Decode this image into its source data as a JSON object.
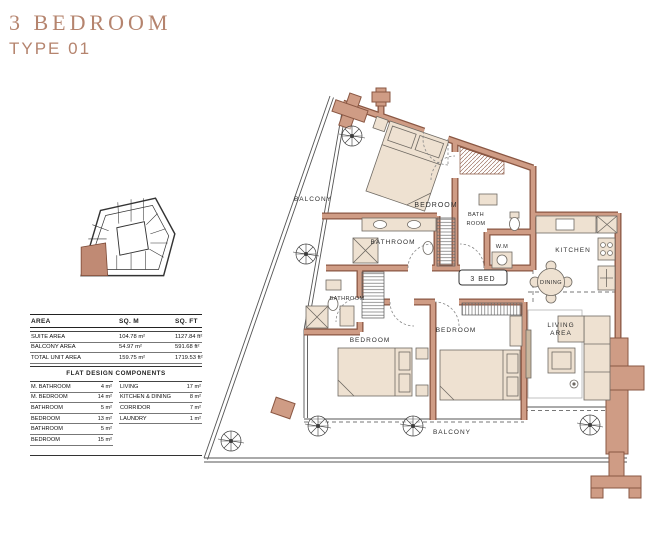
{
  "title": {
    "line1": "3 BEDROOM",
    "line2": "TYPE 01"
  },
  "colors": {
    "accent": "#b5846e",
    "wall_fill": "#cf9c85",
    "wall_edge": "#8a5743",
    "furniture": "#eee1d1",
    "line": "#3c3c3c"
  },
  "area_table": {
    "headers": [
      "AREA",
      "SQ. M",
      "SQ. FT"
    ],
    "rows": [
      {
        "label": "SUITE AREA",
        "sqm": "104.78 m²",
        "sqft": "1127.84 ft²"
      },
      {
        "label": "BALCONY AREA",
        "sqm": "54.97 m²",
        "sqft": "591.68 ft²"
      },
      {
        "label": "TOTAL UNIT AREA",
        "sqm": "159.75 m²",
        "sqft": "1719.53 ft²"
      }
    ]
  },
  "components": {
    "title": "FLAT DESIGN COMPONENTS",
    "left": [
      {
        "label": "M. BATHROOM",
        "value": "4 m²"
      },
      {
        "label": "M. BEDROOM",
        "value": "14 m²"
      },
      {
        "label": "BATHROOM",
        "value": "5 m²"
      },
      {
        "label": "BEDROOM",
        "value": "13 m²"
      },
      {
        "label": "BATHROOM",
        "value": "5 m²"
      },
      {
        "label": "BEDROOM",
        "value": "15 m²"
      }
    ],
    "right": [
      {
        "label": "LIVING",
        "value": "17 m²"
      },
      {
        "label": "KITCHEN & DINING",
        "value": "8 m²"
      },
      {
        "label": "CORRIDOR",
        "value": "7 m²"
      },
      {
        "label": "LAUNDRY",
        "value": "1 m²"
      }
    ]
  },
  "plan": {
    "labels": {
      "balcony_left": "BALCONY",
      "bedroom_top": "BEDROOM",
      "bath_line1": "BATH",
      "bath_line2": "ROOM",
      "wm": "W.M",
      "kitchen": "KITCHEN",
      "dining": "DINING",
      "bed_badge": "3 BED",
      "living_line1": "LIVING",
      "living_line2": "AREA",
      "bathroom_1": "BATHROOM",
      "bathroom_2": "BATHROOM",
      "bedroom_bl": "BEDROOM",
      "bedroom_bm": "BEDROOM",
      "balcony_bottom": "BALCONY"
    }
  }
}
